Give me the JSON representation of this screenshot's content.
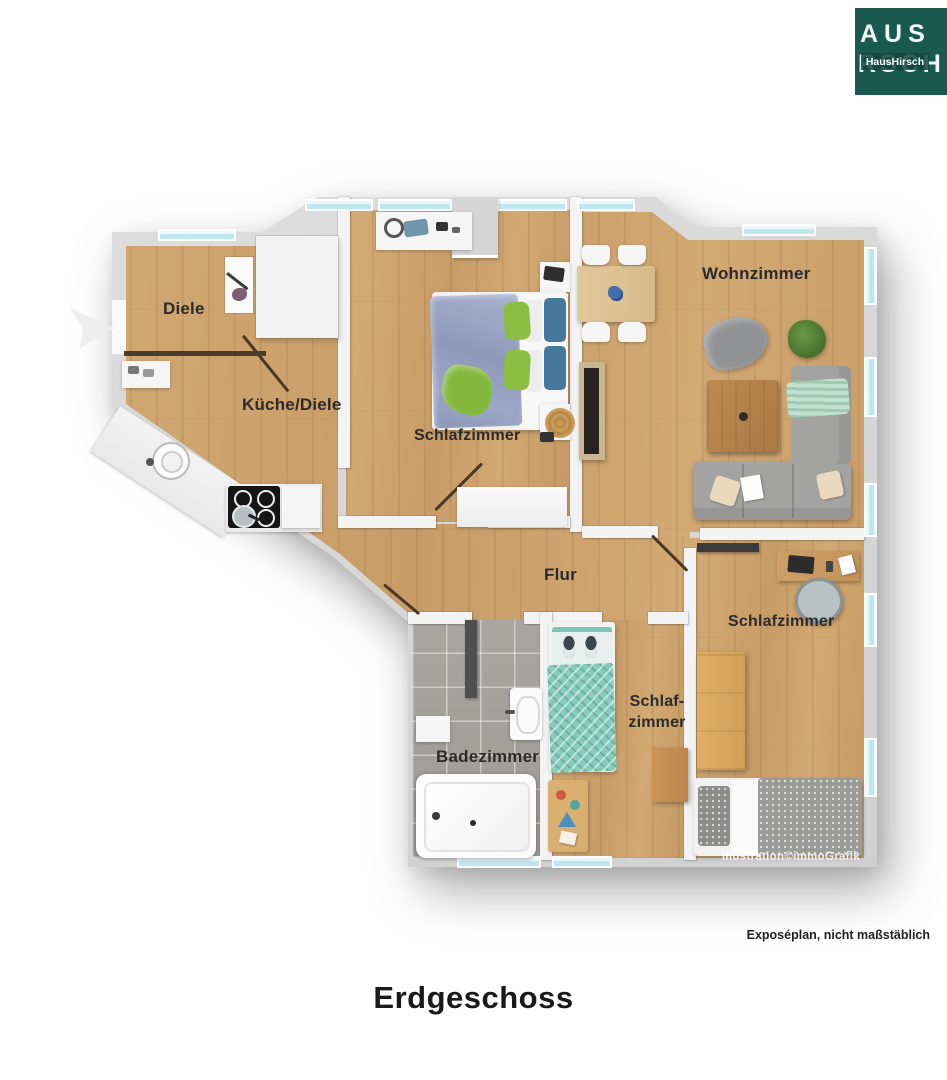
{
  "title": "Erdgeschoss",
  "disclaimer": "Exposéplan, nicht maßstäblich",
  "watermark": "Illustration©immoGrafik",
  "logo": {
    "line1": "AUS",
    "line2": "RSCH",
    "badge": "HausHirsch",
    "bg_color": "#185a4f"
  },
  "rooms": {
    "diele": "Diele",
    "kueche": "Küche/Diele",
    "schlafzimmer_top": "Schlafzimmer",
    "wohnzimmer": "Wohnzimmer",
    "flur": "Flur",
    "badezimmer": "Badezimmer",
    "schlafzimmer_klein_line1": "Schlaf-",
    "schlafzimmer_klein_line2": "zimmer",
    "schlafzimmer_rechts": "Schlafzimmer"
  },
  "colors": {
    "wall_gray": "#d8d8d8",
    "wood_floor": "#cfa26c",
    "bath_tile": "#a5a19d",
    "window_blue": "#d9f1f7",
    "logo_green": "#185a4f",
    "door_line": "#4a3726"
  }
}
